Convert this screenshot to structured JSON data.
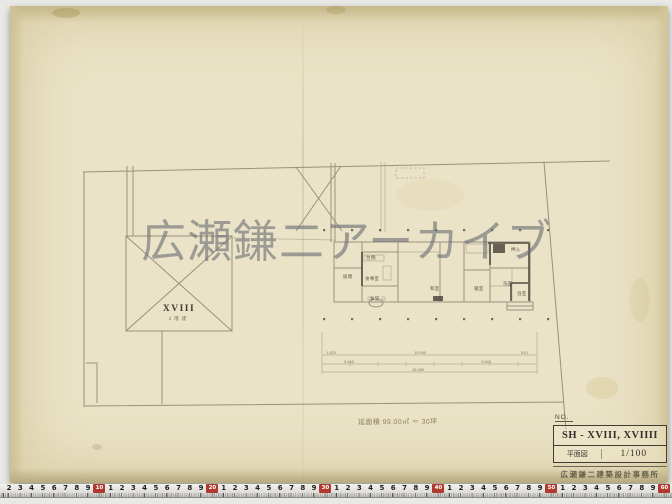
{
  "watermark": {
    "text": "広瀬鎌二アーカイブ"
  },
  "site": {
    "label": "XVIII",
    "sublabel": "2階建"
  },
  "note": {
    "text": "延面積 99.00㎡ ＝ 30坪"
  },
  "title_block": {
    "no_label": "NO.",
    "title": "SH - XVIII, XVIIII",
    "drawing_type": "平面図",
    "scale": "1/100",
    "stamp": "広瀬鎌二建築設計事務所"
  },
  "plan": {
    "room_labels": [
      {
        "t": "台所",
        "x": 366,
        "y": 255
      },
      {
        "t": "居間",
        "x": 343,
        "y": 274
      },
      {
        "t": "食事室",
        "x": 365,
        "y": 276
      },
      {
        "t": "食堂",
        "x": 370,
        "y": 296
      },
      {
        "t": "和室",
        "x": 430,
        "y": 286
      },
      {
        "t": "押入",
        "x": 511,
        "y": 247
      },
      {
        "t": "寝室",
        "x": 474,
        "y": 286
      },
      {
        "t": "洗面",
        "x": 503,
        "y": 281
      },
      {
        "t": "浴室",
        "x": 517,
        "y": 291
      }
    ],
    "dim_labels": [
      {
        "t": "1,820",
        "x": 326,
        "y": 350
      },
      {
        "t": "15,900",
        "x": 414,
        "y": 350
      },
      {
        "t": "910",
        "x": 521,
        "y": 350
      },
      {
        "t": "3,640",
        "x": 344,
        "y": 359
      },
      {
        "t": "3,640",
        "x": 481,
        "y": 359
      },
      {
        "t": "16,380",
        "x": 412,
        "y": 367
      }
    ]
  },
  "ruler": {
    "sequence": [
      "2",
      "3",
      "4",
      "5",
      "6",
      "7",
      "8",
      "9",
      "#10",
      "1",
      "2",
      "3",
      "4",
      "5",
      "6",
      "7",
      "8",
      "9",
      "#20",
      "1",
      "2",
      "3",
      "4",
      "5",
      "6",
      "7",
      "8",
      "9",
      "#30",
      "1",
      "2",
      "3",
      "4",
      "5",
      "6",
      "7",
      "8",
      "9",
      "#40",
      "1",
      "2",
      "3",
      "4",
      "5",
      "6",
      "7",
      "8",
      "9",
      "#50",
      "1",
      "2",
      "3",
      "4",
      "5",
      "6",
      "7",
      "8",
      "9",
      "#60"
    ]
  },
  "colors": {
    "paper": "#ebe3c7",
    "paper_edge": "#c9bd92",
    "pencil": "#8b8371",
    "pencil_dark": "#454035",
    "ruler_red": "#b03a2e",
    "watermark_gray": "#686a70"
  }
}
